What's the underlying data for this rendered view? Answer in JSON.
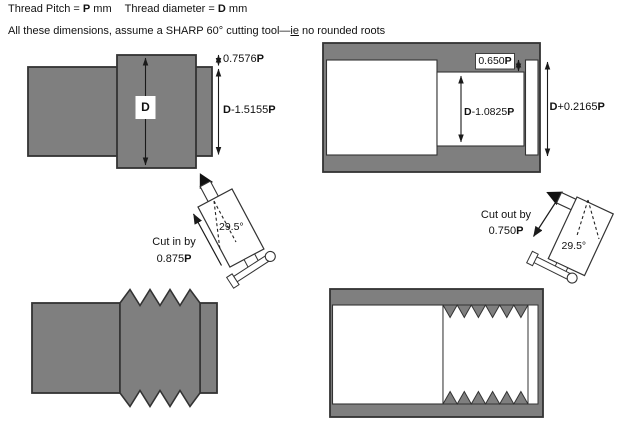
{
  "header": {
    "line1": {
      "pitch_pre": "Thread Pitch = ",
      "pitch_sym": "P",
      "pitch_post": " mm",
      "dia_pre": "Thread diameter = ",
      "dia_sym": "D",
      "dia_post": " mm"
    },
    "line2": {
      "pre": "All these dimensions, assume a SHARP 60° cutting tool—",
      "ie": "ie",
      "post": " no rounded roots"
    }
  },
  "external_blank": {
    "diameter_label": "D",
    "thread_depth": {
      "num": "0.7576",
      "p": "P"
    },
    "root_diameter": {
      "d": "D",
      "mid": "-1.5155",
      "p": "P"
    }
  },
  "internal_blank": {
    "thread_depth": {
      "num": "0.650",
      "p": "P"
    },
    "bore_diameter": {
      "d": "D",
      "mid": "-1.0825",
      "p": "P"
    },
    "major_diameter": {
      "d": "D",
      "mid": "+0.2165",
      "p": "P"
    }
  },
  "tool_in": {
    "caption": "Cut in by",
    "amount": {
      "num": "0.875",
      "p": "P"
    },
    "angle": "29.5°"
  },
  "tool_out": {
    "caption": "Cut out by",
    "amount": {
      "num": "0.750",
      "p": "P"
    },
    "angle": "29.5°"
  },
  "colors": {
    "steel_gray": "#7f7f7f",
    "outline": "#333333",
    "ink": "#1a1a1a",
    "background": "#ffffff"
  }
}
